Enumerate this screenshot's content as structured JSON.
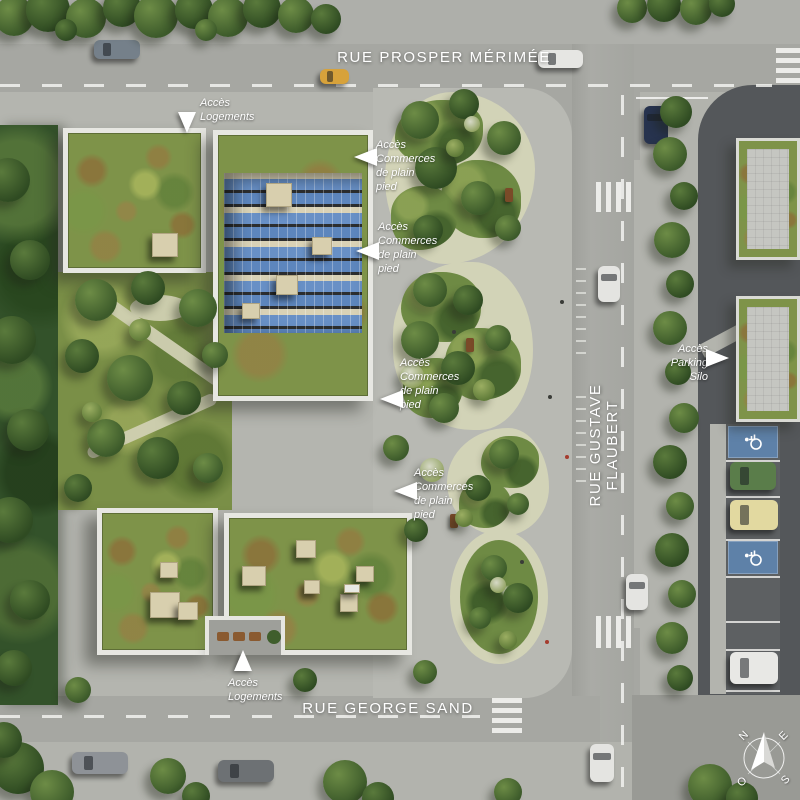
{
  "streets": {
    "prosper_merimee": "RUE PROSPER MÉRIMÉE",
    "gustave_flaubert": "RUE GUSTAVE FLAUBERT",
    "george_sand": "RUE GEORGE SAND"
  },
  "annotations": {
    "acces_logements_top": "Accès\nLogements",
    "acces_commerces_1": "Accès\nCommerces\nde plain\npied",
    "acces_commerces_2": "Accès\nCommerces\nde plain\npied",
    "acces_commerces_3": "Accès\nCommerces\nde plain\npied",
    "acces_commerces_4": "Accès\nCommerces\nde plain\npied",
    "acces_parking_silo": "Accès\nParking Silo",
    "acces_logements_bottom": "Accès\nLogements"
  },
  "compass": {
    "north": "N",
    "east": "E",
    "south": "S",
    "west": "O"
  },
  "palette": {
    "road": "#a6a7a2",
    "pavement": "#b7b8b2",
    "charcoal_deck": "#54575a",
    "lawn_green": "#7a8f47",
    "sedum_green": "#7e9349",
    "sedum_brown": "#96663d",
    "solar_panel_blue": "#6890c6",
    "parapet_white": "#e7e7e2",
    "disabled_parking_blue": "#5e81a8",
    "gravel_path": "#d2d3b7",
    "label_text": "#ffffff"
  }
}
